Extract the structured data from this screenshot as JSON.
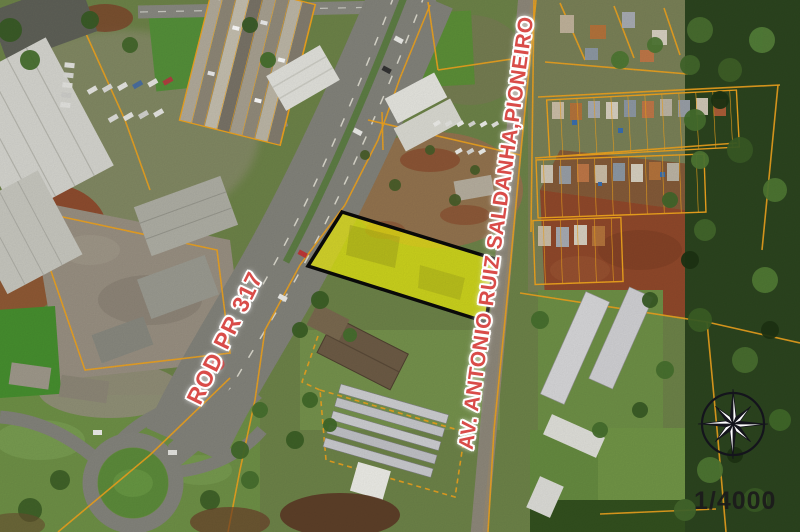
{
  "map": {
    "description": "Aerial cadastral photo-map with highlighted parcel",
    "scale_label": "1/4000",
    "road_labels": [
      {
        "id": "rod",
        "text": "ROD PR 317"
      },
      {
        "id": "avenue",
        "text": "AV. ANTONIO RUIZ SALDANHA,PIONEIRO"
      }
    ],
    "highlight_parcel": {
      "fill": "#f2f20c",
      "stroke": "#0a0a0a",
      "opacity": 0.72
    },
    "compass": {
      "type": "8-point compass rose"
    },
    "colors": {
      "cadastral_line": "#f0a41e",
      "road_label": "#d94c49",
      "label_halo": "#ffffff",
      "scale_text": "#1b1b1b",
      "compass_ring": "#14141c",
      "asphalt": "#84847c",
      "forest": "#2c451f",
      "field_green": "#6f9147",
      "dirt_red": "#8f4a2c",
      "roof_light": "#d7d7d1"
    }
  }
}
